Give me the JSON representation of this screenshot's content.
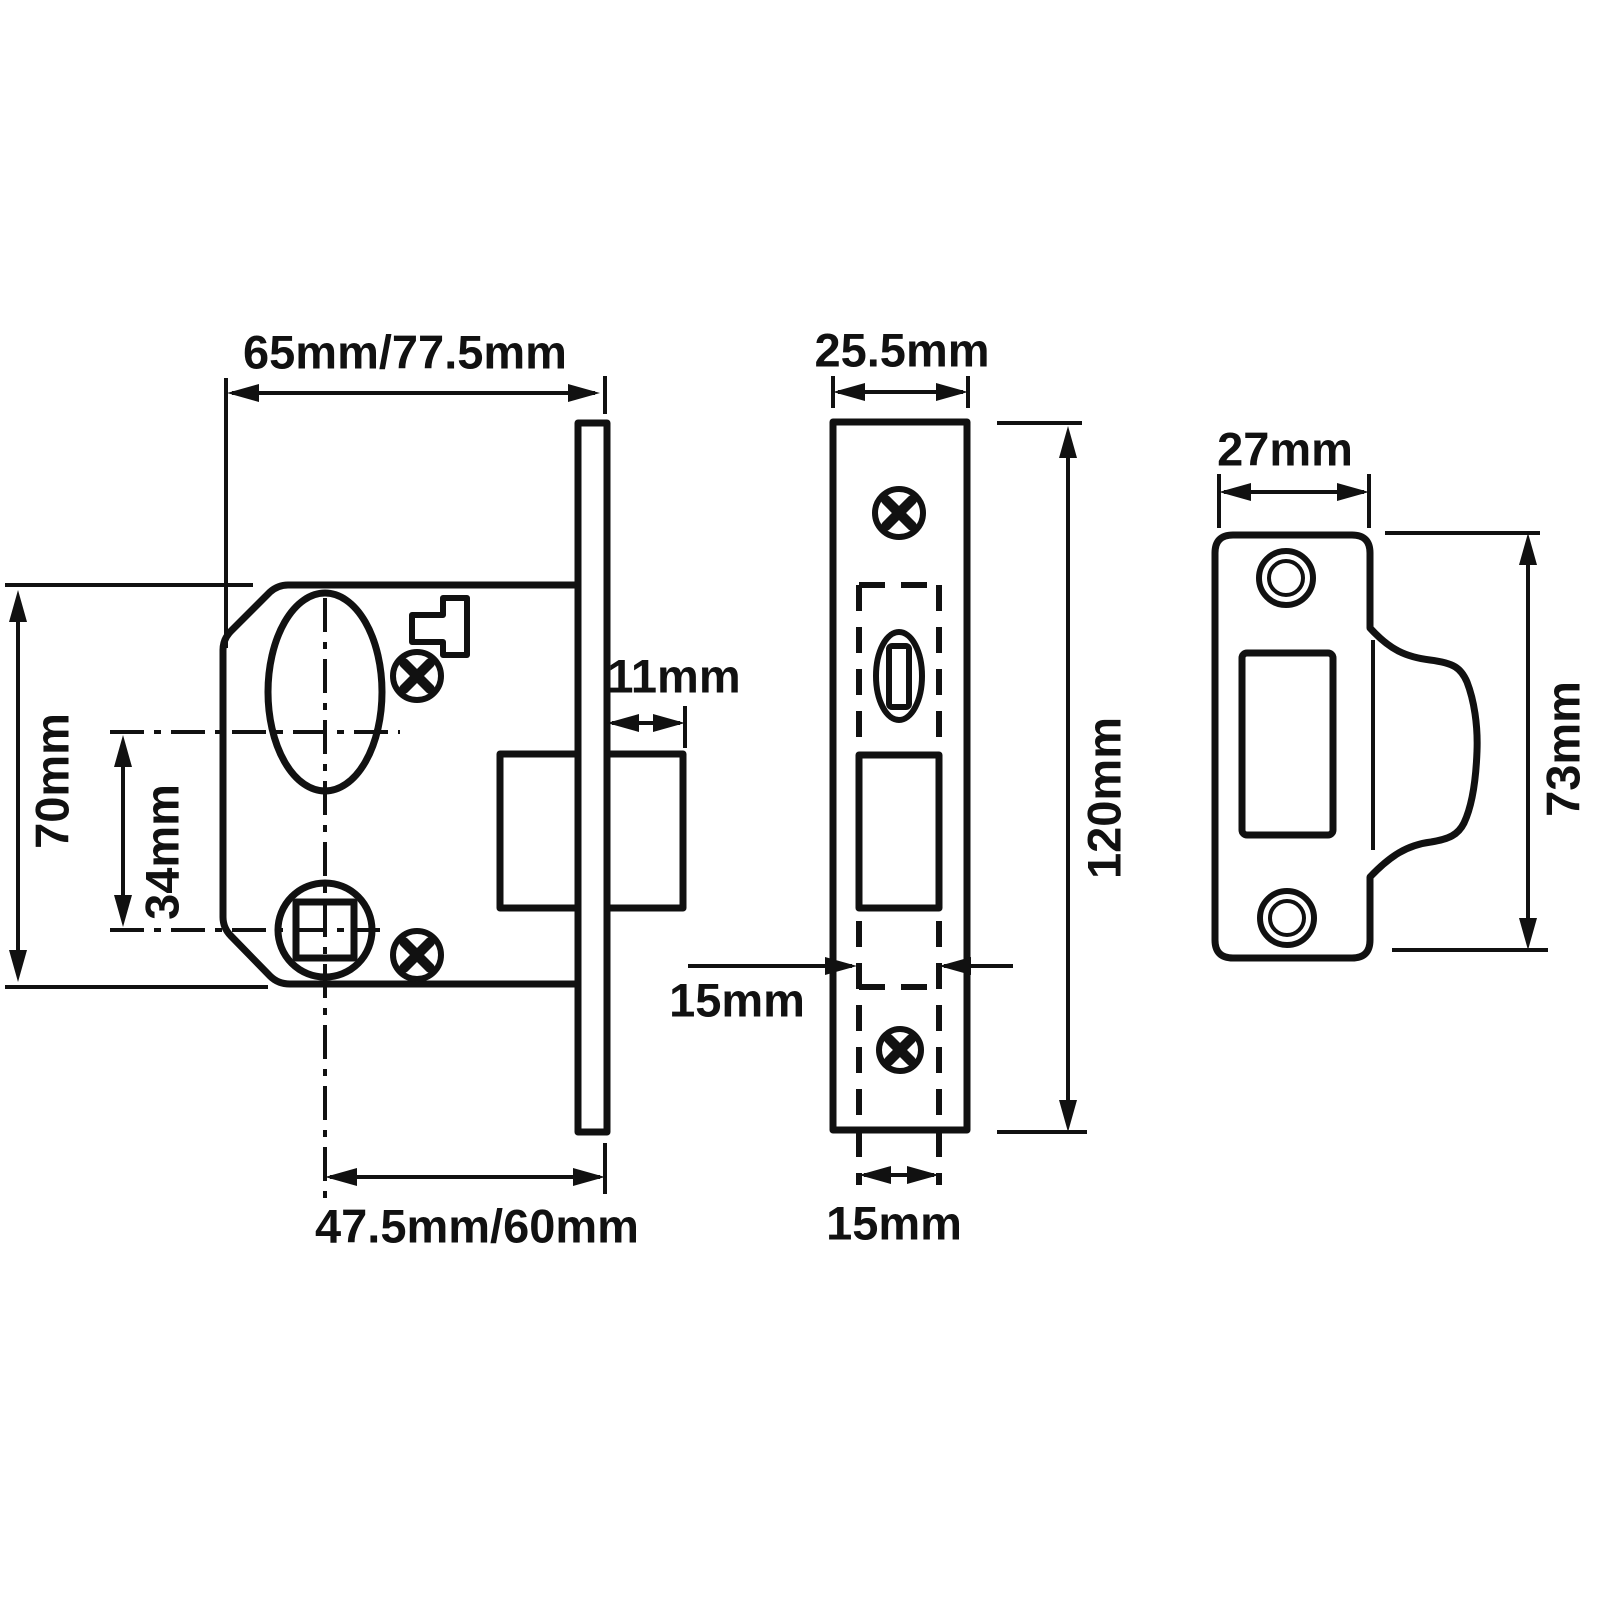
{
  "drawing": {
    "background_color": "#ffffff",
    "line_color": "#111111",
    "dims": {
      "body_width": "65mm/77.5mm",
      "body_height": "70mm",
      "cylinder_to_spindle": "34mm",
      "bolt_projection": "11mm",
      "backset": "47.5mm/60mm",
      "faceplate_width": "25.5mm",
      "faceplate_height": "120mm",
      "case_width": "15mm",
      "case_width_bottom": "15mm",
      "strike_width": "27mm",
      "strike_height": "73mm"
    }
  }
}
